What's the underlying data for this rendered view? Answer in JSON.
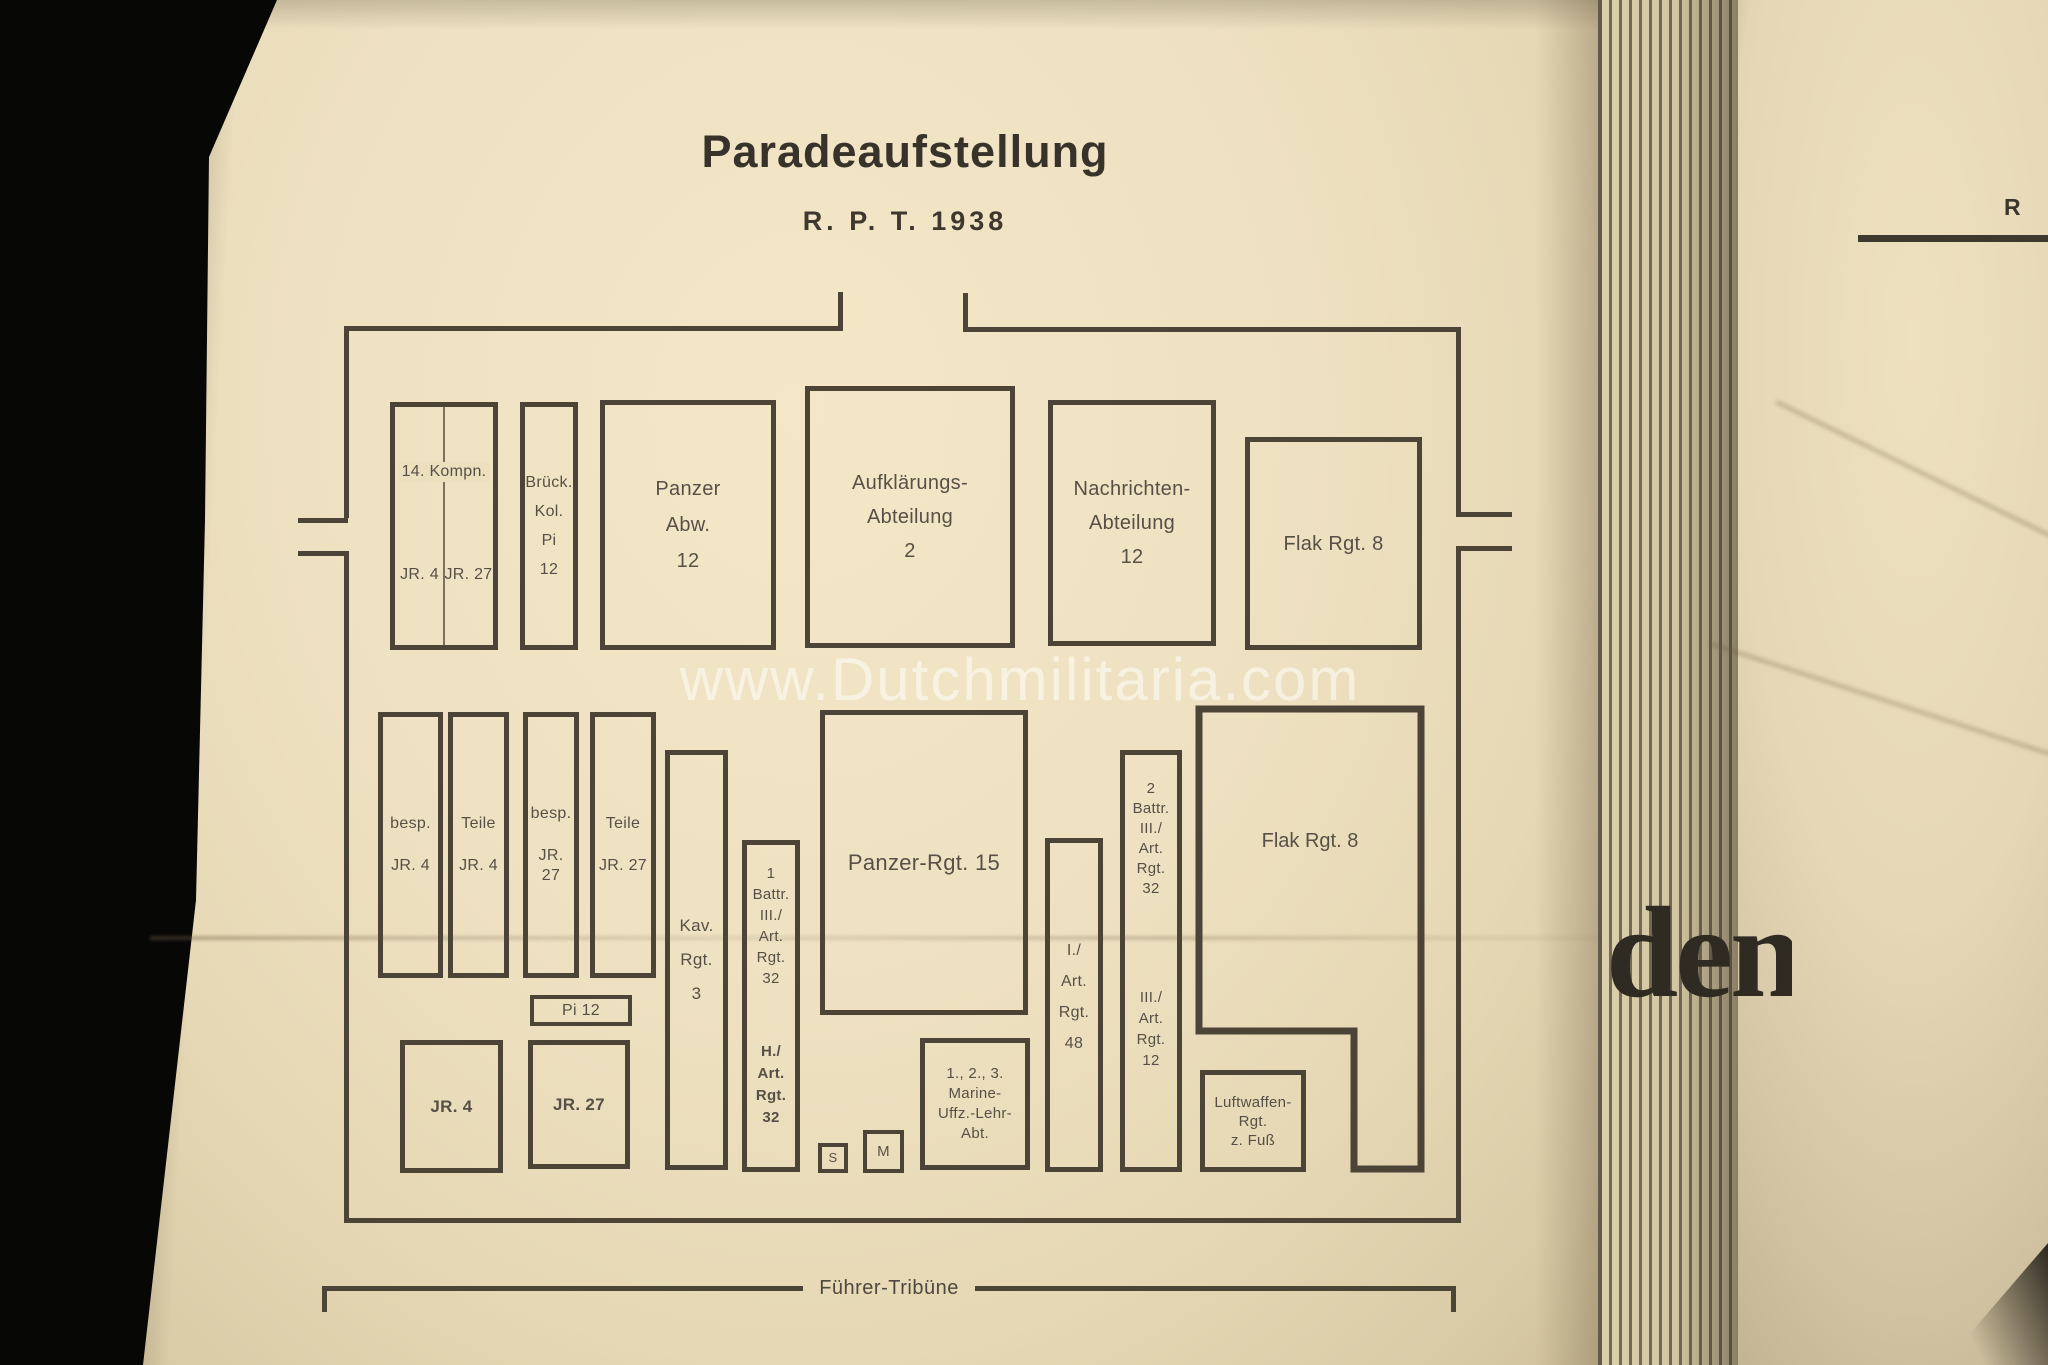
{
  "photo": {
    "watermark": "www.Dutchmilitaria.com"
  },
  "document": {
    "title": "Paradeaufstellung",
    "subtitle": "R. P. T. 1938",
    "tribune_label": "Führer-Tribüne"
  },
  "diagram": {
    "top": {
      "kompn": {
        "label": "14. Kompn.",
        "sub_left": "JR. 4",
        "sub_right": "JR. 27"
      },
      "brueck": {
        "lines": [
          "Brück.",
          "Kol.",
          "Pi",
          "12"
        ]
      },
      "panzer_abw": {
        "lines": [
          "Panzer",
          "Abw.",
          "12"
        ]
      },
      "aufklaerung": {
        "lines": [
          "Aufklärungs-",
          "Abteilung",
          "2"
        ]
      },
      "nachrichten": {
        "lines": [
          "Nachrichten-",
          "Abteilung",
          "12"
        ]
      },
      "flak": {
        "label": "Flak Rgt. 8"
      }
    },
    "middle": {
      "besp_jr4": {
        "lines": [
          "besp.",
          "JR. 4"
        ]
      },
      "teile_jr4": {
        "lines": [
          "Teile",
          "JR. 4"
        ]
      },
      "besp_jr27": {
        "lines": [
          "besp.",
          "JR. 27"
        ]
      },
      "teile_jr27": {
        "lines": [
          "Teile",
          "JR. 27"
        ]
      },
      "kav": {
        "lines": [
          "Kav.",
          "Rgt.",
          "3"
        ]
      },
      "battr1": {
        "upper": [
          "1",
          "Battr.",
          "III./",
          "Art.",
          "Rgt.",
          "32"
        ],
        "lower": [
          "H./",
          "Art.",
          "Rgt.",
          "32"
        ]
      },
      "panzer15": {
        "label": "Panzer-Rgt. 15"
      },
      "art48": {
        "lines": [
          "I./",
          "Art.",
          "Rgt.",
          "48"
        ]
      },
      "battr2": {
        "upper": [
          "2",
          "Battr.",
          "III./",
          "Art.",
          "Rgt.",
          "32"
        ],
        "lower": [
          "III./",
          "Art.",
          "Rgt.",
          "12"
        ]
      },
      "flak": {
        "label": "Flak Rgt. 8"
      }
    },
    "bottom": {
      "pi12": {
        "label": "Pi 12"
      },
      "jr4": {
        "label": "JR. 4"
      },
      "jr27": {
        "label": "JR. 27"
      },
      "s": {
        "label": "S"
      },
      "m": {
        "label": "M"
      },
      "marine": {
        "lines": [
          "1., 2., 3.",
          "Marine-",
          "Uffz.-Lehr-",
          "Abt."
        ]
      },
      "luftwaffe": {
        "lines": [
          "Luftwaffen-",
          "Rgt.",
          "z. Fuß"
        ]
      }
    }
  },
  "right_page": {
    "header_fragment": "R",
    "word_fragment": "den"
  },
  "colors": {
    "background": "#070706",
    "paper": "#ece0bf",
    "ink": "#4c4437",
    "text": "#575046",
    "watermark": "rgba(255,255,255,0.52)"
  }
}
